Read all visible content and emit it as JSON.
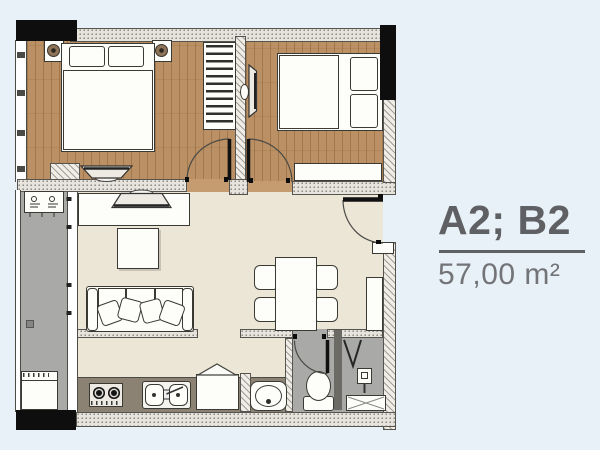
{
  "unit_panel": {
    "unit_code": "A2; B2",
    "area": "57,00 m²"
  },
  "colors": {
    "page-bg": "#e9f1f8",
    "wood": "#bb9064",
    "living": "#ebe6d6",
    "wet": "#a9a9a7",
    "counter": "#8b8273",
    "wall-fill": "#e6e4dd",
    "wall-edge": "#55544e",
    "column": "#0e0e0e",
    "furn-fill": "#fdfdfa",
    "furn-line": "#3a3a35",
    "label-dark": "#5f6064",
    "label-light": "#737478",
    "threshold-wood": "#c59c6f"
  },
  "fixtures": [
    "double-bed",
    "nightstand",
    "table-lamp",
    "wardrobe",
    "tv",
    "sofa",
    "coffee-table",
    "tv-console",
    "dining-table",
    "dining-chair",
    "shoe-cabinet",
    "desk",
    "stove",
    "kitchen-sink",
    "fridge",
    "wash-basin",
    "toilet",
    "shower-head",
    "shower-tray",
    "washing-machine",
    "ac-unit",
    "floor-drain",
    "balcony-railing",
    "entrance-door",
    "interior-door"
  ]
}
